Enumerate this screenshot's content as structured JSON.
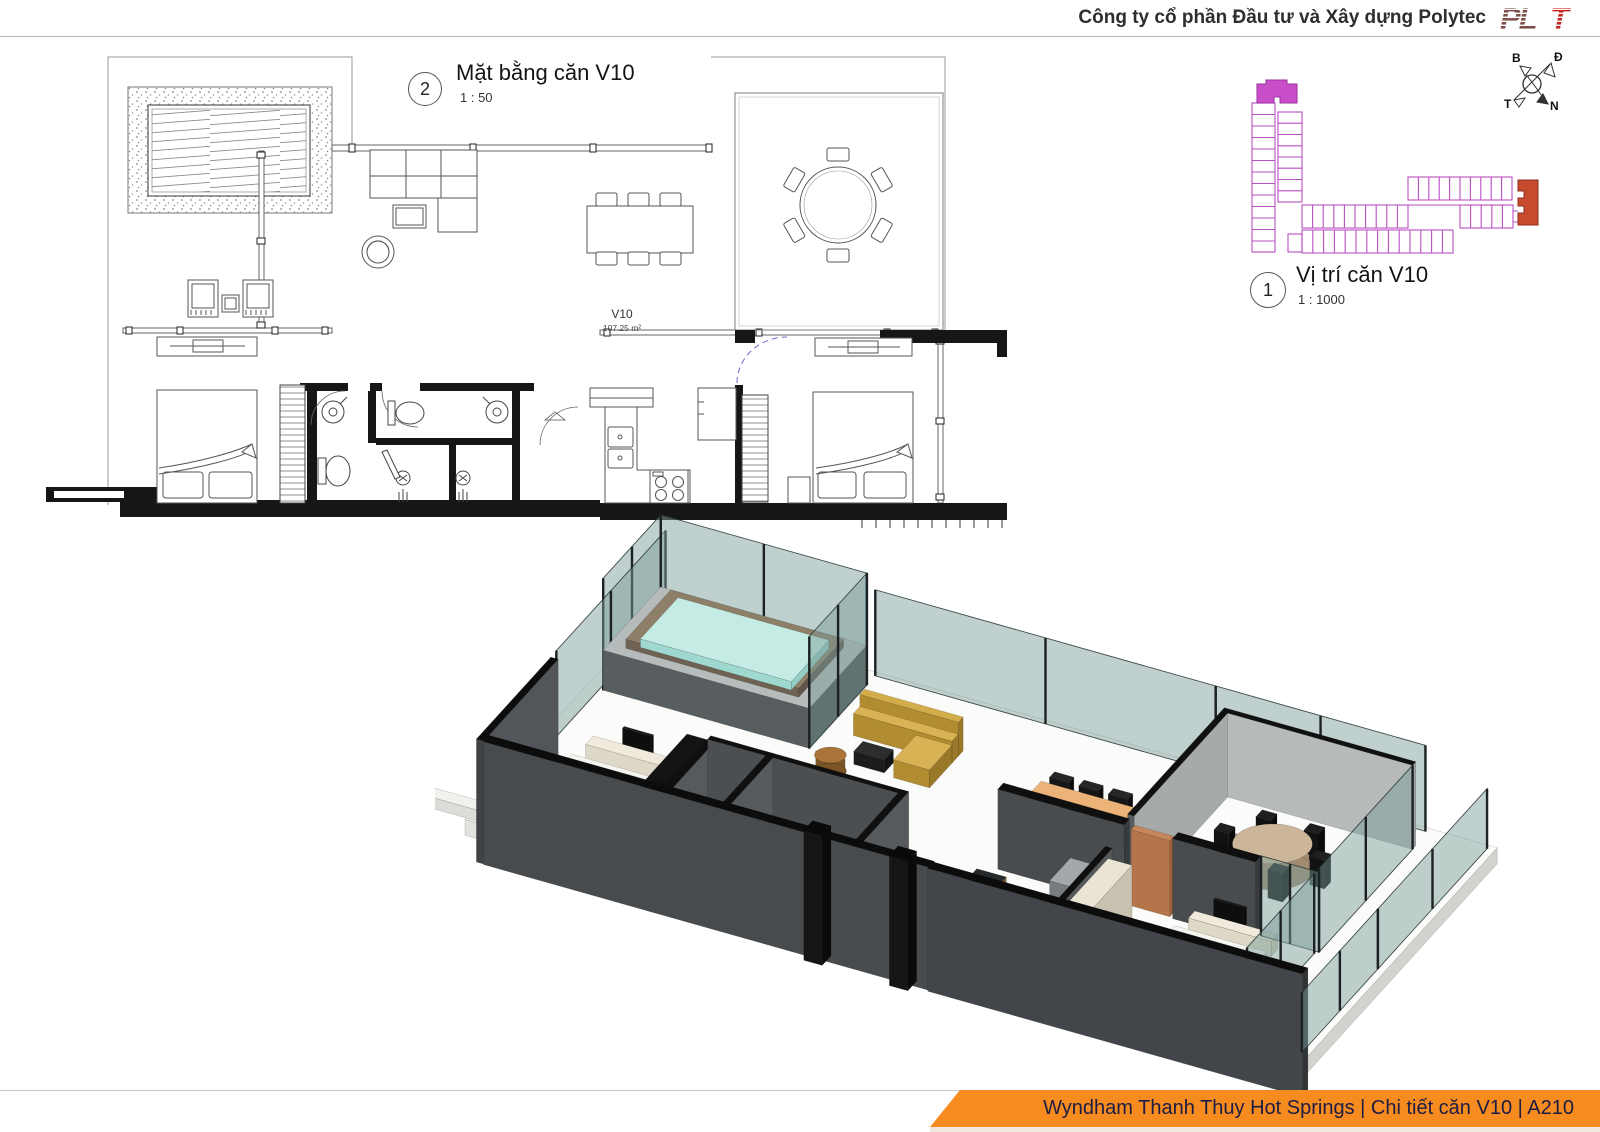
{
  "header": {
    "company": "Công ty cổ phần Đầu tư và Xây dựng Polytec",
    "logo": {
      "part1": "PL",
      "part2": "T"
    }
  },
  "floor_plan": {
    "view_number": "2",
    "title": "Mặt bằng căn V10",
    "scale": "1 : 50",
    "unit_code": "V10",
    "unit_area": "107.25 m²"
  },
  "site_plan": {
    "view_number": "1",
    "title": "Vị trí căn V10",
    "scale": "1 : 1000"
  },
  "compass": {
    "north": "B",
    "east": "Đ",
    "west": "T",
    "south": "N"
  },
  "footer": {
    "text": "Wyndham Thanh Thuy Hot Springs | Chi tiết căn V10 | A210",
    "project": "Wyndham Thanh Thuy Hot Springs",
    "sheet": "Chi tiết căn V10",
    "number": "A210"
  },
  "colors": {
    "banner_orange": "#F68B1F",
    "site_outline": "#B84FC2",
    "site_selected_block": "#C94FC9",
    "site_selected_unit": "#C64A2E",
    "logo_dark": "#7D4E4A",
    "logo_red": "#C9251C",
    "pool_water": "#C4ECE5"
  }
}
